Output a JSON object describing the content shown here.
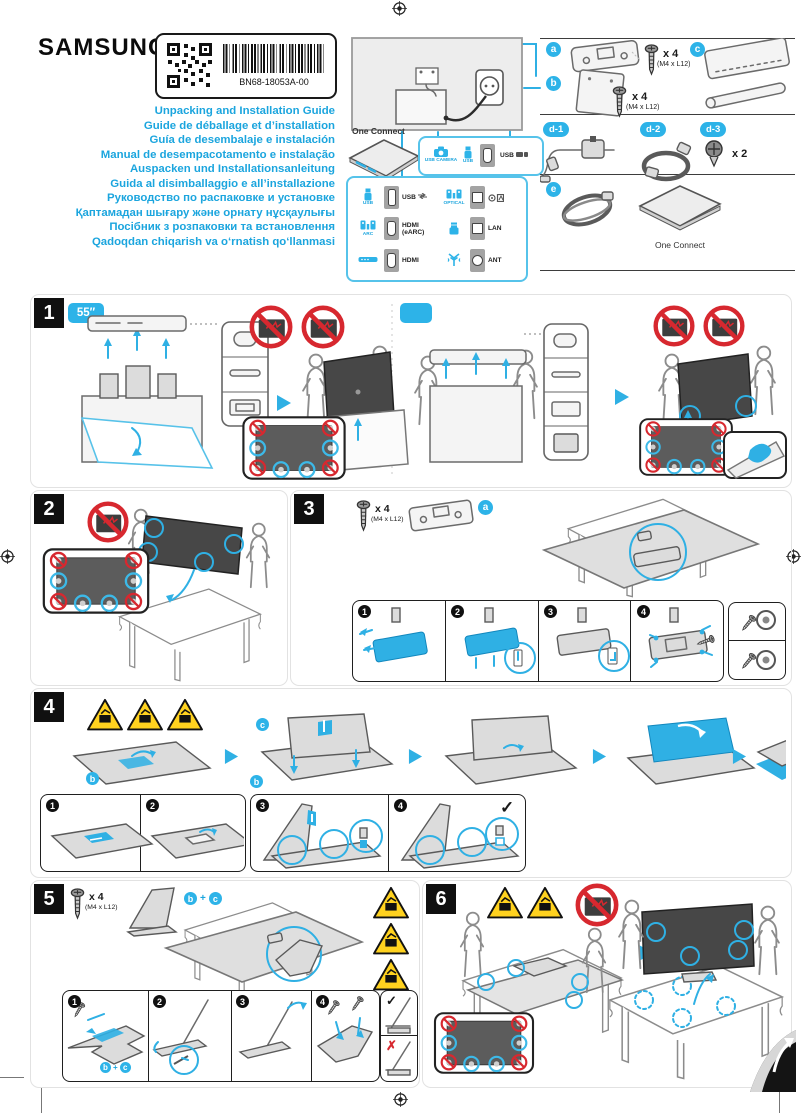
{
  "colors": {
    "accent": "#1ba5de",
    "badge": "#2db3e8",
    "warning": "#ffd21f",
    "danger": "#d7282f",
    "ink": "#1a1a1a"
  },
  "header": {
    "brand": "SAMSUNG",
    "part_number": "BN68-18053A-00",
    "titles": [
      "Unpacking and Installation Guide",
      "Guide de déballage et d’installation",
      "Guía de desembalaje e instalación",
      "Manual de desempacotamento e instalação",
      "Auspacken und Installationsanleitung",
      "Guida al disimballaggio e all’installazione",
      "Руководство по распаковке и установке",
      "Қаптамадан шығару және орнату нұсқаулығы",
      "Посібник з розпаковки та встановлення",
      "Qadoqdan chiqarish va o‘rnatish qo‘llanmasi"
    ]
  },
  "one_connect": {
    "label": "One Connect",
    "top_panel": {
      "camera_label": "USB CAMERA",
      "usb_label": "USB",
      "port_label": "USB"
    },
    "left_rows": [
      {
        "icon_label": "USB",
        "port_label": "USB"
      },
      {
        "icon_label": "ARC",
        "port_label": "HDMI",
        "port_sublabel": "(eARC)"
      },
      {
        "icon_label": "",
        "port_label": "HDMI"
      }
    ],
    "right_rows": [
      {
        "icon_label": "OPTICAL",
        "port_label": ""
      },
      {
        "icon_label": "",
        "port_label": "LAN"
      },
      {
        "icon_label": "",
        "port_label": "ANT"
      }
    ]
  },
  "parts": {
    "a": {
      "badge": "a",
      "qty": "x 4",
      "spec": "(M4 x L12)"
    },
    "b": {
      "badge": "b",
      "qty": "x 4",
      "spec": "(M4 x L12)"
    },
    "c": {
      "badge": "c"
    },
    "d1": {
      "badge": "d-1"
    },
    "d2": {
      "badge": "d-2"
    },
    "d3": {
      "badge": "d-3",
      "qty": "x 2"
    },
    "e": {
      "badge": "e",
      "label": "One Connect"
    }
  },
  "sections": {
    "s1": {
      "num": "1",
      "size_badge": "55″"
    },
    "s2": {
      "num": "2"
    },
    "s3": {
      "num": "3",
      "qty": "x 4",
      "spec": "(M4 x L12)",
      "steps": [
        "1",
        "2",
        "3",
        "4"
      ]
    },
    "s4": {
      "num": "4",
      "steps": [
        "1",
        "2",
        "3",
        "4"
      ],
      "check": "✓"
    },
    "s5": {
      "num": "5",
      "qty": "x 4",
      "spec": "(M4 x L12)",
      "plus": "+",
      "steps": [
        "1",
        "2",
        "3",
        "4"
      ],
      "check": "✓",
      "cross": "✗"
    },
    "s6": {
      "num": "6"
    }
  }
}
